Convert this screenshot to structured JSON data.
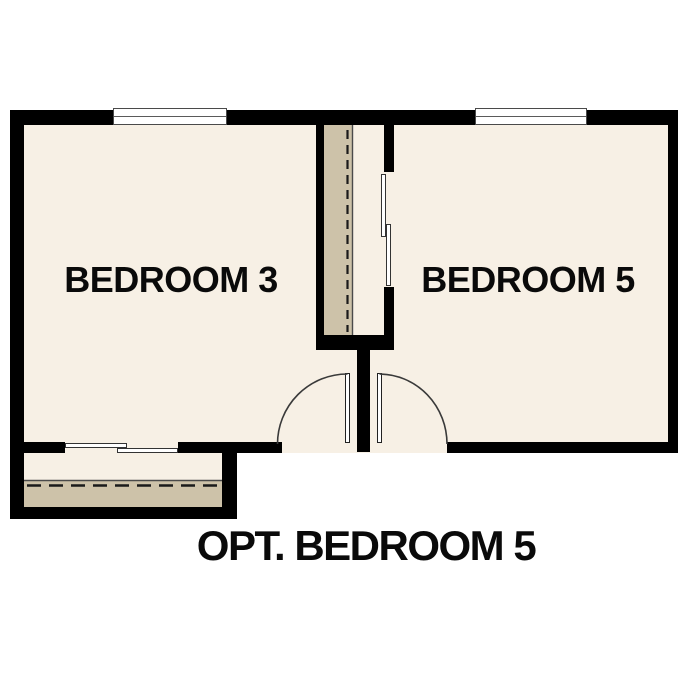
{
  "plan": {
    "rooms": [
      {
        "id": "bedroom-3",
        "label": "BEDROOM 3"
      },
      {
        "id": "bedroom-5",
        "label": "BEDROOM 5"
      }
    ],
    "caption": "OPT. BEDROOM 5",
    "features": [
      "window-icon",
      "window-icon",
      "bypass-closet-door-icon",
      "bypass-closet-door-icon",
      "hinged-door-swing-icon",
      "hinged-door-swing-icon",
      "closet-rod-dashed-line",
      "closet-rod-dashed-line"
    ],
    "colors": {
      "wall": "#000000",
      "floor": "#f7f0e5",
      "closet_fill": "#cdc2a9",
      "line": "#3a3a3a",
      "background": "#ffffff",
      "text": "#0a0a0a"
    }
  }
}
